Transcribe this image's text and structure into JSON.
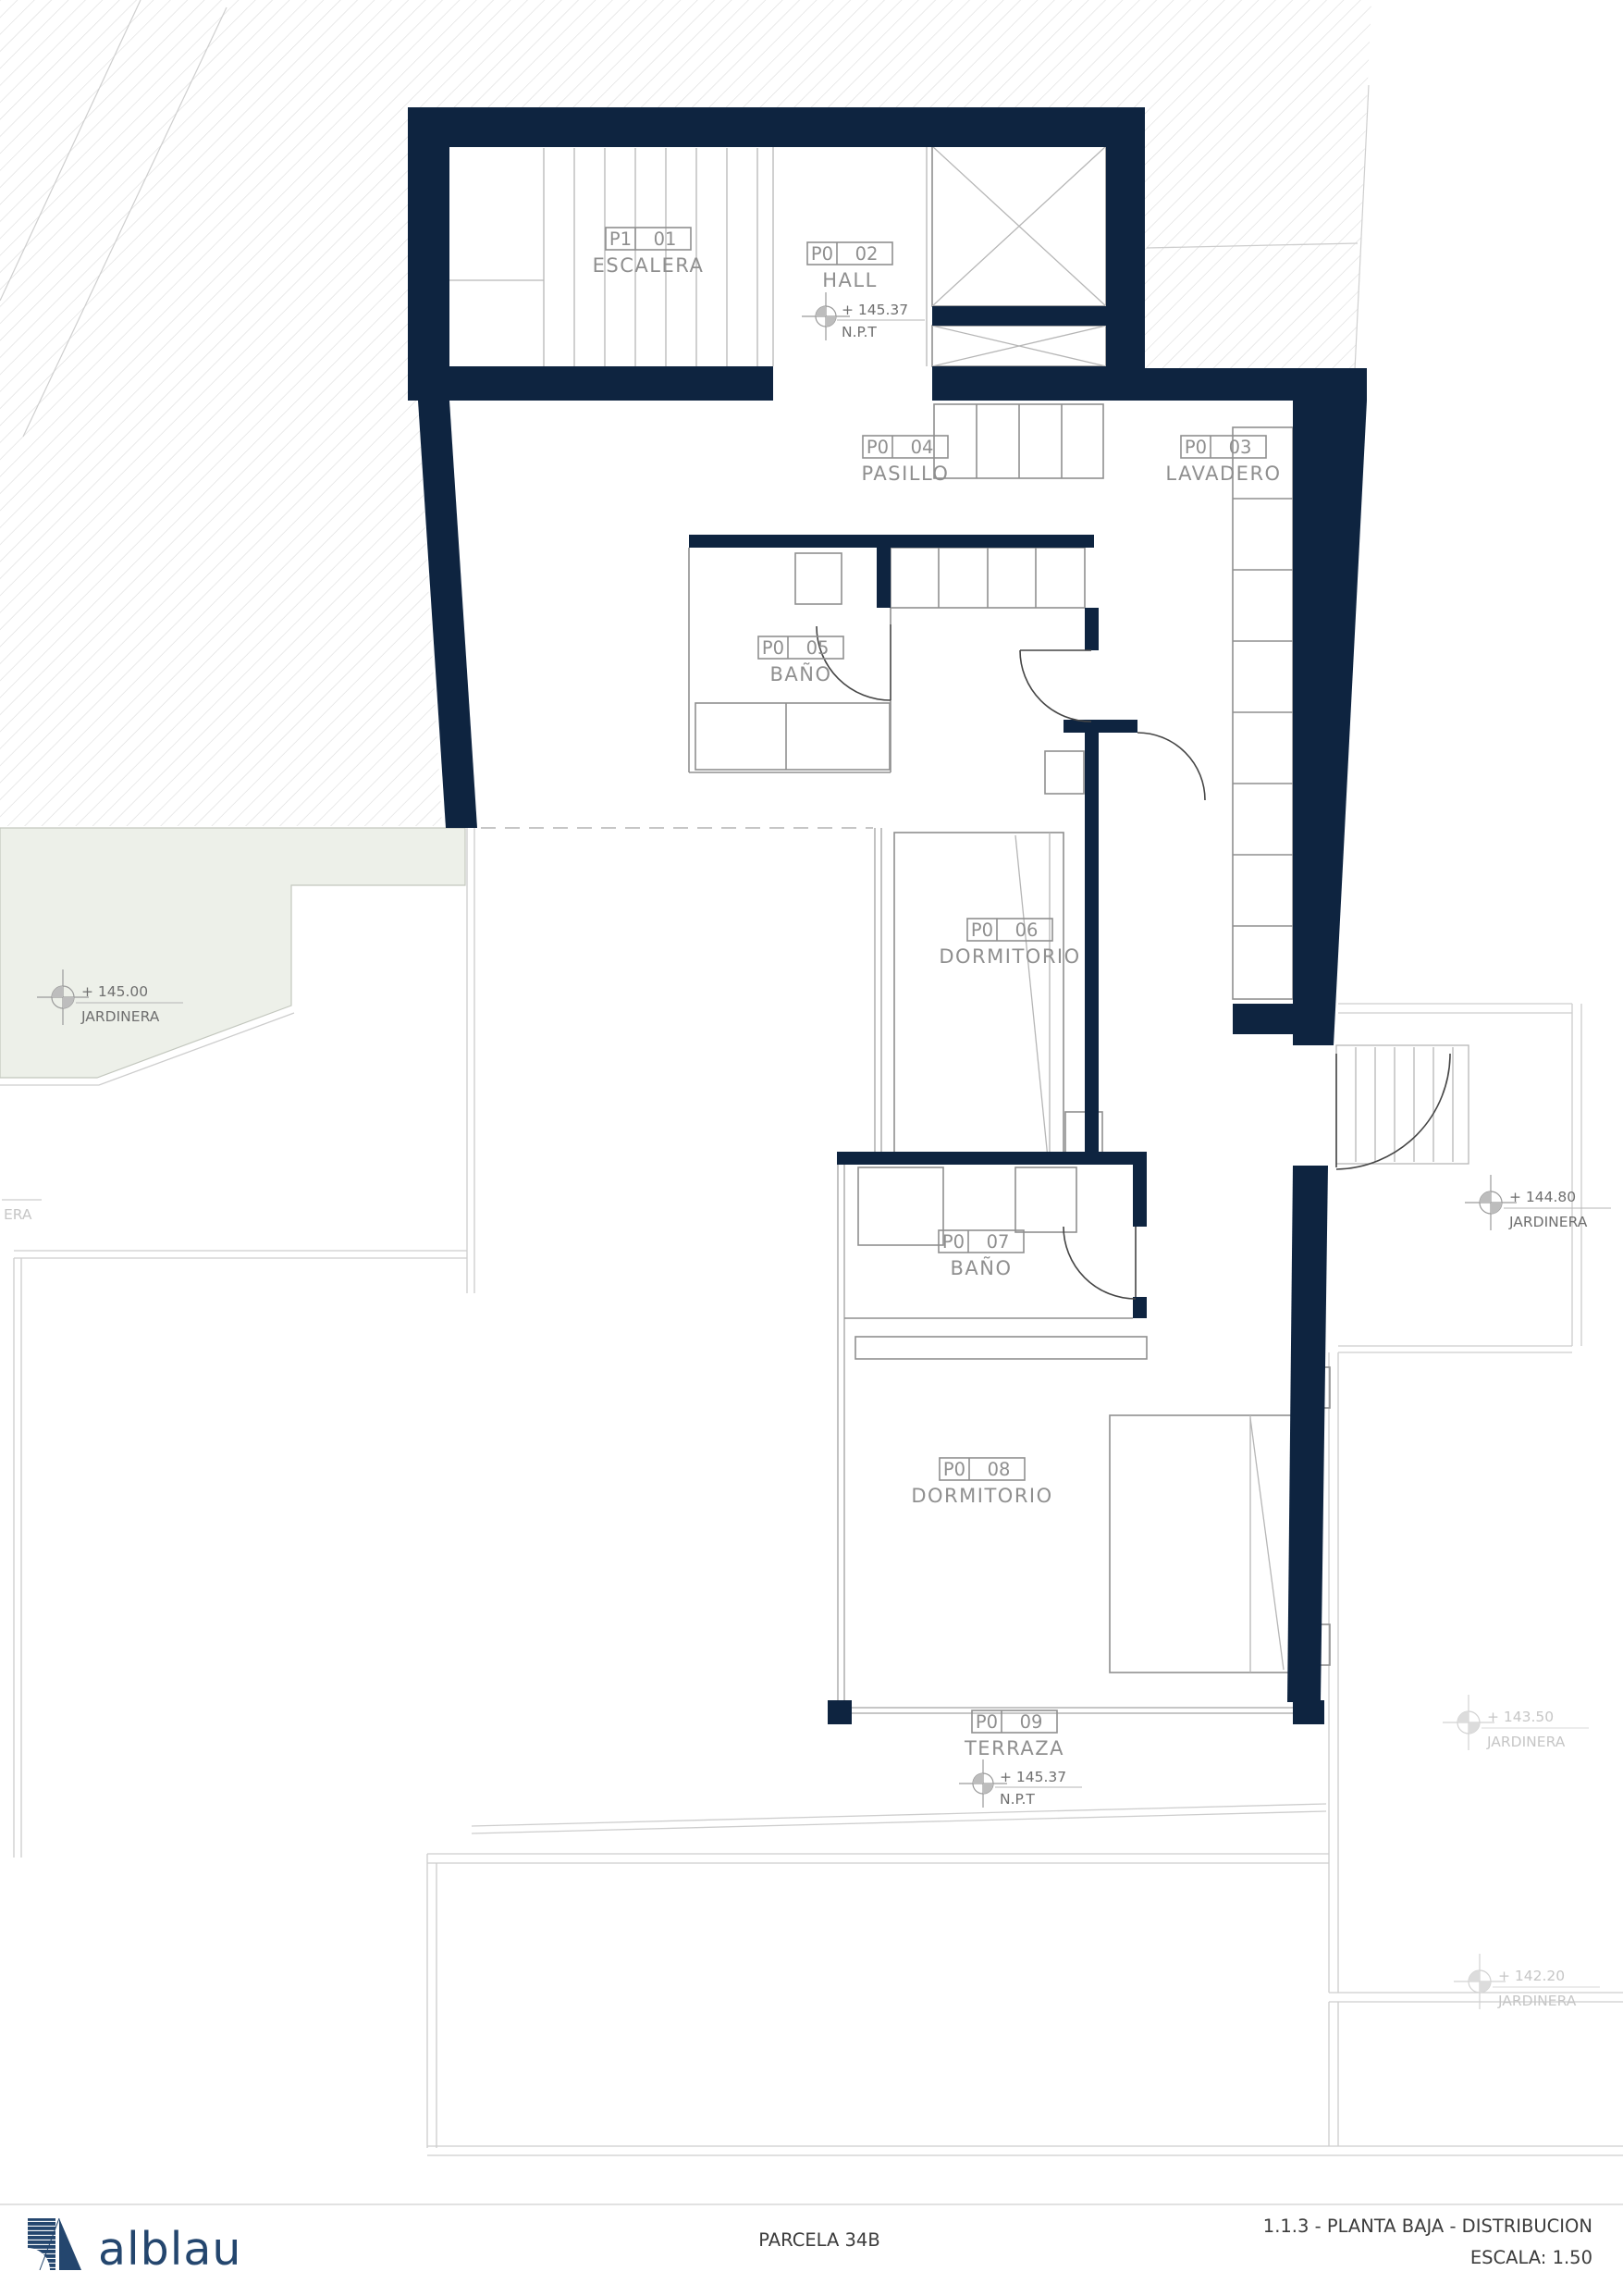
{
  "colors": {
    "wall_navy": "#0e2440",
    "brand_navy": "#24466e",
    "jardinera_green": "#edf0e9",
    "line_gray": "#8f8f8f"
  },
  "rooms": [
    {
      "code": "P1",
      "num": "01",
      "name": "ESCALERA"
    },
    {
      "code": "P0",
      "num": "02",
      "name": "HALL"
    },
    {
      "code": "P0",
      "num": "04",
      "name": "PASILLO"
    },
    {
      "code": "P0",
      "num": "03",
      "name": "LAVADERO"
    },
    {
      "code": "P0",
      "num": "05",
      "name": "BAÑO"
    },
    {
      "code": "P0",
      "num": "06",
      "name": "DORMITORIO"
    },
    {
      "code": "P0",
      "num": "07",
      "name": "BAÑO"
    },
    {
      "code": "P0",
      "num": "08",
      "name": "DORMITORIO"
    },
    {
      "code": "P0",
      "num": "09",
      "name": "TERRAZA"
    }
  ],
  "levels": {
    "hall": {
      "value": "+ 145.37",
      "label": "N.P.T"
    },
    "terraza": {
      "value": "+ 145.37",
      "label": "N.P.T"
    },
    "jardinera_left": {
      "value": "+ 145.00",
      "label": "JARDINERA"
    },
    "jardinera_right_upper": {
      "value": "+ 144.80",
      "label": "JARDINERA"
    },
    "jardinera_right_mid": {
      "value": "+ 143.50",
      "label": "JARDINERA"
    },
    "jardinera_right_lower": {
      "value": "+ 142.20",
      "label": "JARDINERA"
    },
    "jardinera_partial": {
      "label": "ERA"
    }
  },
  "footer": {
    "brand": "alblau",
    "project": "PARCELA 34B",
    "sheet": "1.1.3 - PLANTA BAJA -  DISTRIBUCION",
    "scale": "ESCALA: 1.50"
  }
}
